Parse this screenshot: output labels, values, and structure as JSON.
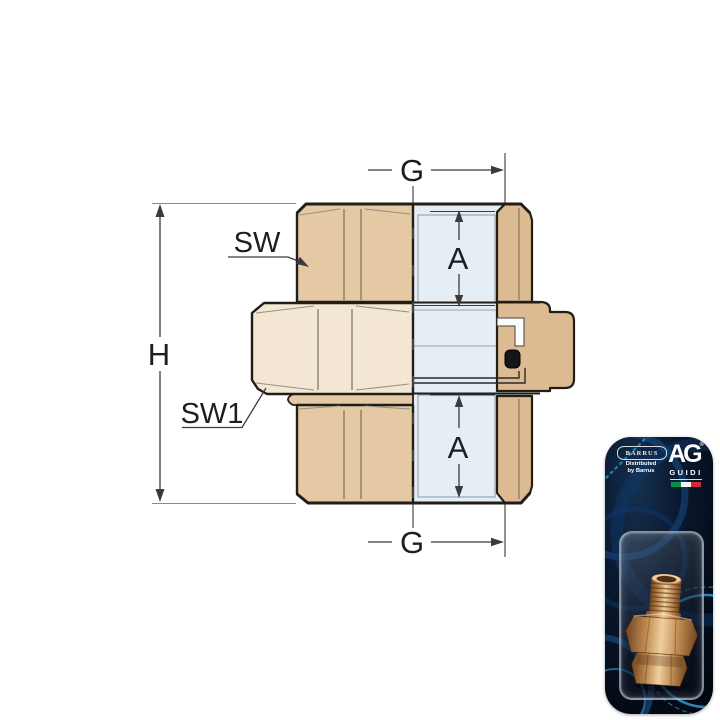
{
  "page": {
    "background": "#ffffff"
  },
  "diagram": {
    "labels": {
      "g_top": "G",
      "g_bottom": "G",
      "h": "H",
      "a_top": "A",
      "a_bottom": "A",
      "sw": "SW",
      "sw1": "SW1"
    },
    "colors": {
      "body_tan": "#e5c9a5",
      "wall_tan": "#dcba92",
      "nut_cream": "#f3e7d4",
      "section_blue": "#e4eef4",
      "outline": "#211d17",
      "thin_line": "#6f675b",
      "bore_line": "#94a1aa",
      "dim_line": "#3b3b3b",
      "ext_line": "#8a8a8a",
      "seal_black": "#161616",
      "channel_white": "#fafcfd"
    }
  },
  "packaging": {
    "brand": "BARRUS",
    "distributed_line1": "Distributed",
    "distributed_line2": "by Barrus",
    "maker_logo": "AG",
    "maker_reg": "®",
    "maker_name": "GUIDI",
    "flag": {
      "green": "#009246",
      "white": "#f4f5f0",
      "red": "#ce2b37"
    },
    "card_colors": {
      "swirl_bright": "#2d9fd6",
      "swirl_mid": "#1b5fa8",
      "swirl_deep": "#0d3a6e"
    },
    "brass_colors": {
      "light": "#f0cf9d",
      "mid": "#c08a52",
      "dark": "#70451f",
      "rim": "#4e3015"
    }
  }
}
